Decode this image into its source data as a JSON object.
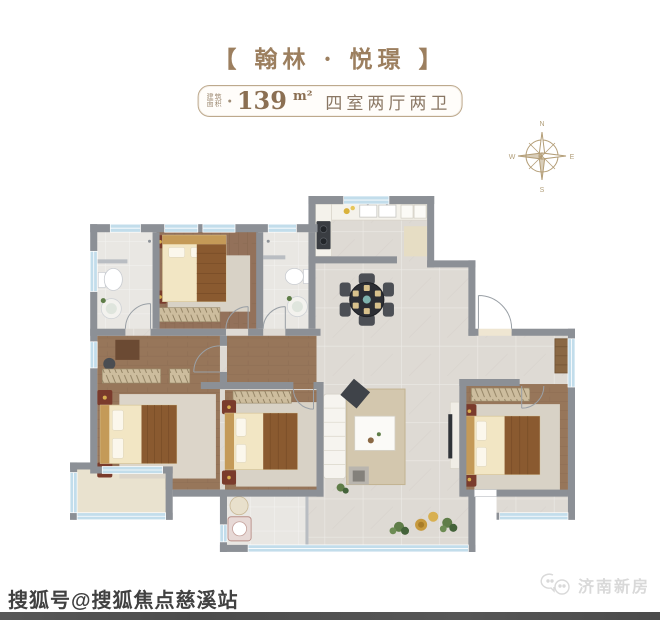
{
  "header": {
    "title": "【 翰林 · 悦璟 】",
    "area_badge": {
      "label_top": "建筑",
      "label_bottom": "面积",
      "bullet": "●",
      "value": "139",
      "unit": "m²",
      "rooms": "四室两厅两卫"
    }
  },
  "compass": {
    "n": "N",
    "e": "E",
    "s": "S",
    "w": "W"
  },
  "colors": {
    "accent_tan": "#9c7f5f",
    "badge_border": "#bda98d",
    "wall_gray": "#8c9096",
    "window_blue": "#c2ddeb",
    "wood_floor": "#96755a",
    "tile_light": "#dedad4",
    "balcony_beige": "#e9e2cf",
    "bed_cream": "#f2e6c4",
    "blanket_brown": "#8a5a30",
    "maroon_accent": "#7a3b2c",
    "dining_table_dark": "#2c2e34",
    "compass_tan": "#b39d76"
  },
  "watermarks": {
    "bottom_left": "搜狐号@搜狐焦点慈溪站",
    "bottom_right": "济南新房"
  }
}
